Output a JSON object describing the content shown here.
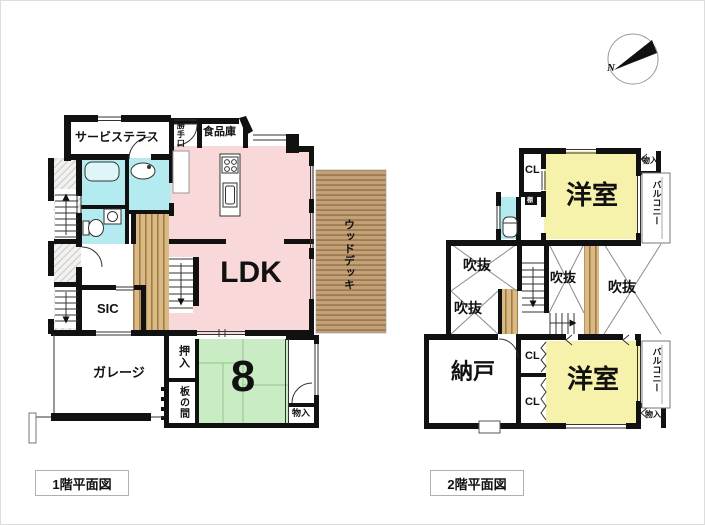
{
  "compass": {
    "north_label": "N"
  },
  "captions": {
    "floor1": "1階平面図",
    "floor2": "2階平面図"
  },
  "floor1": {
    "service_terrace": "サービステラス",
    "back_door": "勝手口",
    "pantry": "食品庫",
    "ldk": "LDK",
    "wood_deck": "ウッドデッキ",
    "sic": "SIC",
    "garage": "ガレージ",
    "closet_oshiire": "押入",
    "wood_floor_room": "板の間",
    "tatami_mats": "8",
    "storage": "物入"
  },
  "floor2": {
    "closet_top": "CL",
    "western_room_top": "洋室",
    "storage_top": "物入",
    "balcony_top": "バルコニー",
    "shelf": "棚",
    "void_top_left": "吹抜",
    "void_bottom_left": "吹抜",
    "void_center": "吹抜",
    "void_right": "吹抜",
    "storage_room": "納戸",
    "closet_mid": "CL",
    "closet_bottom": "CL",
    "western_room_bottom": "洋室",
    "balcony_bottom": "バルコニー",
    "storage_bottom": "物入"
  },
  "colors": {
    "wall": "#111111",
    "ldk_pink": "#f8d8d8",
    "tatami_green": "#c9ecc4",
    "room_yellow": "#f7f2ab",
    "wet_area_cyan": "#b4ebf0",
    "deck_tan": "#c3a077",
    "hall_wood": "#d9ba83"
  }
}
